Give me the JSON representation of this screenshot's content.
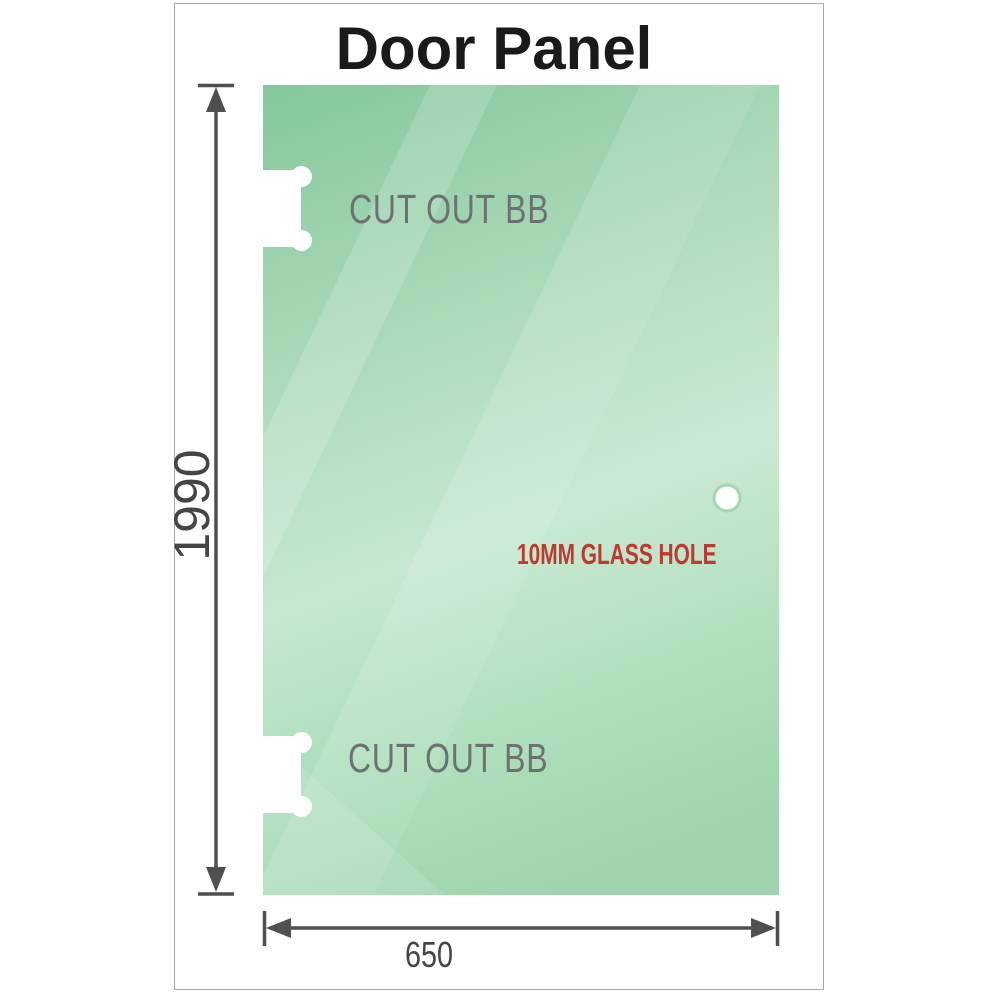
{
  "title": "Door Panel",
  "panel": {
    "description": "glass door panel drawing",
    "cutout_labels": [
      "CUT OUT BB",
      "CUT OUT BB"
    ],
    "hole_label": "10MM GLASS HOLE"
  },
  "dimensions": {
    "height": "1990",
    "width": "650"
  },
  "colors": {
    "glass_dark": "#84c79c",
    "glass_light": "#c6e8d0",
    "glass_bottom": "#96d1a7",
    "dimension_lines": "#4f4f4f",
    "cutout_text": "#6d716f",
    "hole_text": "#bf3a2e",
    "title_text": "#1a1a1a",
    "frame_border": "#a8a8a8"
  }
}
